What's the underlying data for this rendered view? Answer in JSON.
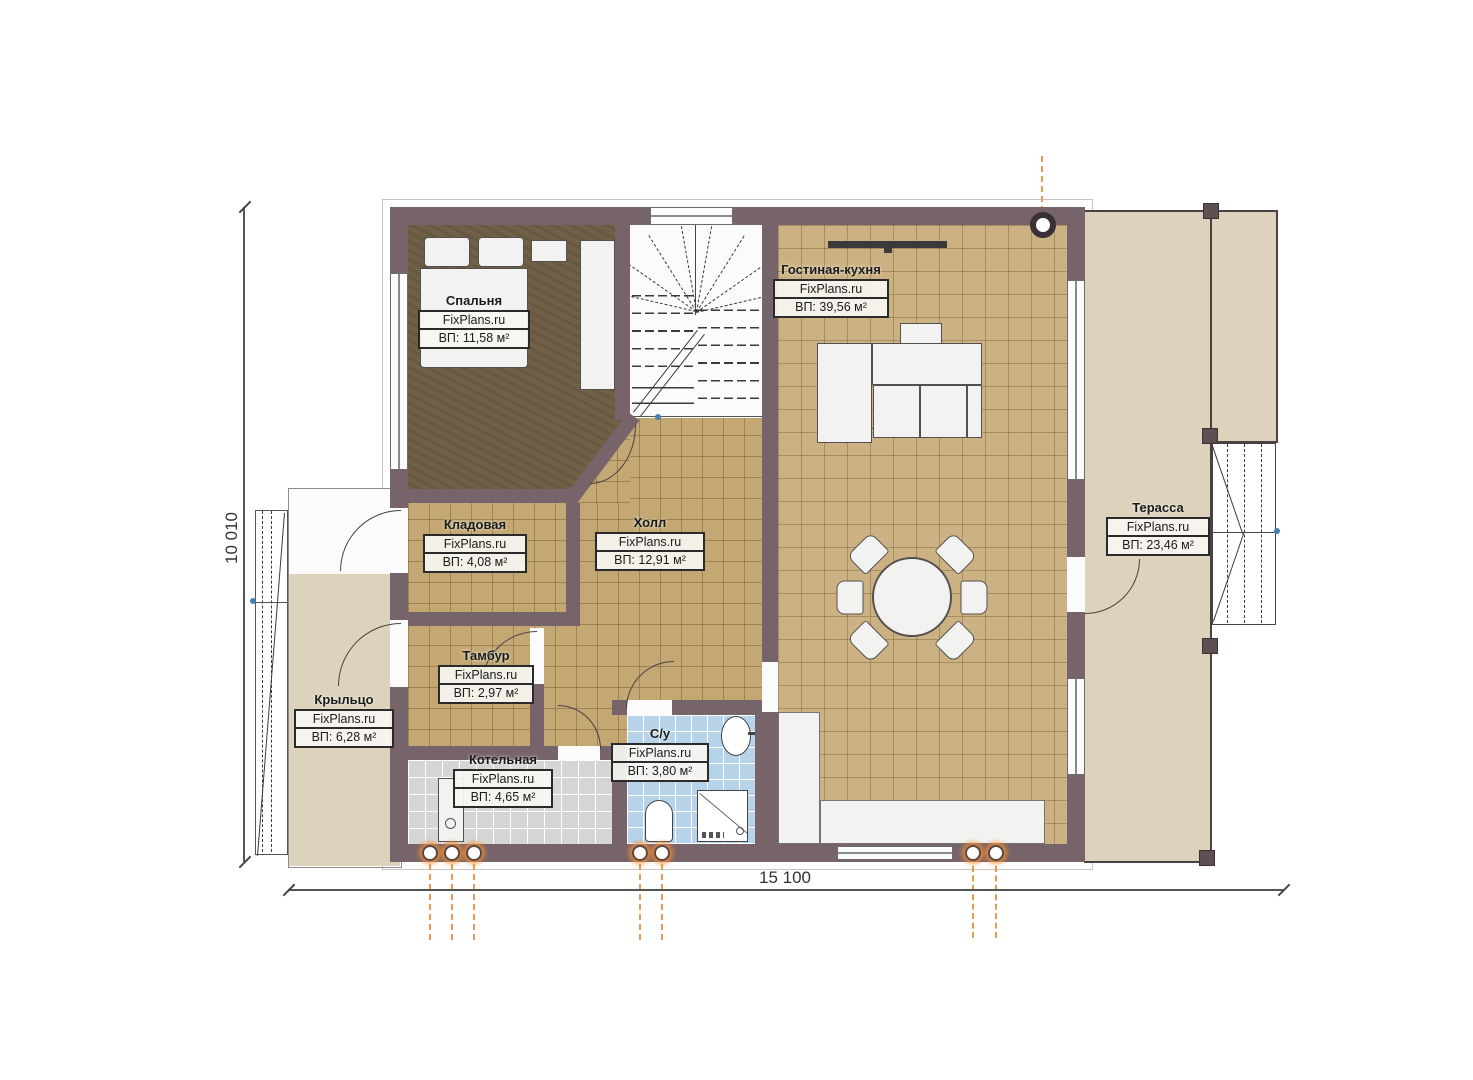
{
  "plan": {
    "brand": "FixPlans.ru",
    "rooms": [
      {
        "key": "bedroom",
        "name": "Спальня",
        "area": "ВП: 11,58 м²"
      },
      {
        "key": "storage",
        "name": "Кладовая",
        "area": "ВП: 4,08 м²"
      },
      {
        "key": "hall",
        "name": "Холл",
        "area": "ВП: 12,91 м²"
      },
      {
        "key": "vestibule",
        "name": "Тамбур",
        "area": "ВП: 2,97 м²"
      },
      {
        "key": "porch",
        "name": "Крыльцо",
        "area": "ВП: 6,28 м²"
      },
      {
        "key": "boiler",
        "name": "Котельная",
        "area": "ВП: 4,65 м²"
      },
      {
        "key": "bathroom",
        "name": "С/у",
        "area": "ВП: 3,80 м²"
      },
      {
        "key": "living",
        "name": "Гостиная-кухня",
        "area": "ВП: 39,56 м²"
      },
      {
        "key": "terrace",
        "name": "Терасса",
        "area": "ВП: 23,46 м²"
      }
    ],
    "dimensions": {
      "bottom": "15 100",
      "left": "10 010"
    },
    "markers": {
      "kitchen_cabinet": "x"
    },
    "colors": {
      "wall": "#77646a",
      "floor_hall": "#c3a873",
      "floor_living": "#ccb282",
      "floor_bedroom": "#6f6046",
      "floor_bath": "#b6d3ea",
      "floor_boiler": "#d6d6d6",
      "outdoor": "#ddd2bb",
      "pipe_glow": "#f58c32",
      "dim_text": "#333333"
    }
  }
}
